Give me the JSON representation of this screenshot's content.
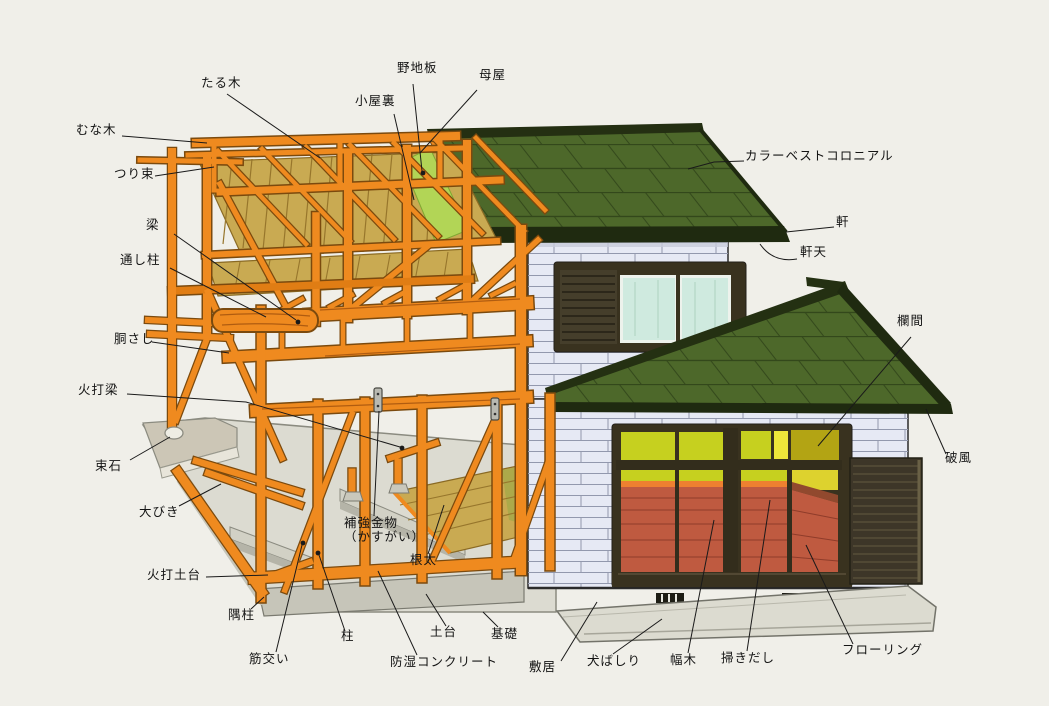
{
  "diagram": {
    "subject": "wooden-house-structure-cutaway",
    "labels": {
      "munagi": "むな木",
      "taruki": "たる木",
      "koyaura": "小屋裏",
      "nojiita": "野地板",
      "moya": "母屋",
      "tsurizuka": "つり束",
      "colorbest": "カラーベストコロニアル",
      "noki": "軒",
      "nokiten": "軒天",
      "hari": "梁",
      "tooshibashira": "通し柱",
      "dousashi": "胴さし",
      "hiuchibari": "火打梁",
      "tsukaishi": "束石",
      "oobiki": "大びき",
      "hiuchidodai": "火打土台",
      "sumibashira": "隅柱",
      "sujikai": "筋交い",
      "hashira": "柱",
      "hokyokanamono": "補強金物\n（かすがい）",
      "neda": "根太",
      "boshitsucon": "防湿コンクリート",
      "dodai": "土台",
      "kiso": "基礎",
      "shikii": "敷居",
      "inubashiri": "犬ばしり",
      "habaki": "幅木",
      "hakidashi": "掃きだし",
      "flooring": "フローリング",
      "ranma": "欄間",
      "hafu": "破風"
    },
    "colors": {
      "background": "#f0efe9",
      "timber_orange": "#ef8a1f",
      "timber_outline": "#7b4a0e",
      "roof_green": "#4d682a",
      "roof_seam": "#33481b",
      "eave_dark": "#1f2a10",
      "sheathing_green": "#b2d556",
      "attic_floor_tan": "#c9aa52",
      "wall_white": "#e6e9f4",
      "brick_joint": "#9298ad",
      "window_frame_dark": "#39321f",
      "glass_blue": "#cfeadf",
      "transom_green": "#c6d01f",
      "transom_yellow": "#eee63a",
      "interior_wall_yellow": "#ddd22e",
      "floor_red": "#bf5a40",
      "concrete": "#dcdbd0",
      "label_text": "#141414"
    }
  }
}
